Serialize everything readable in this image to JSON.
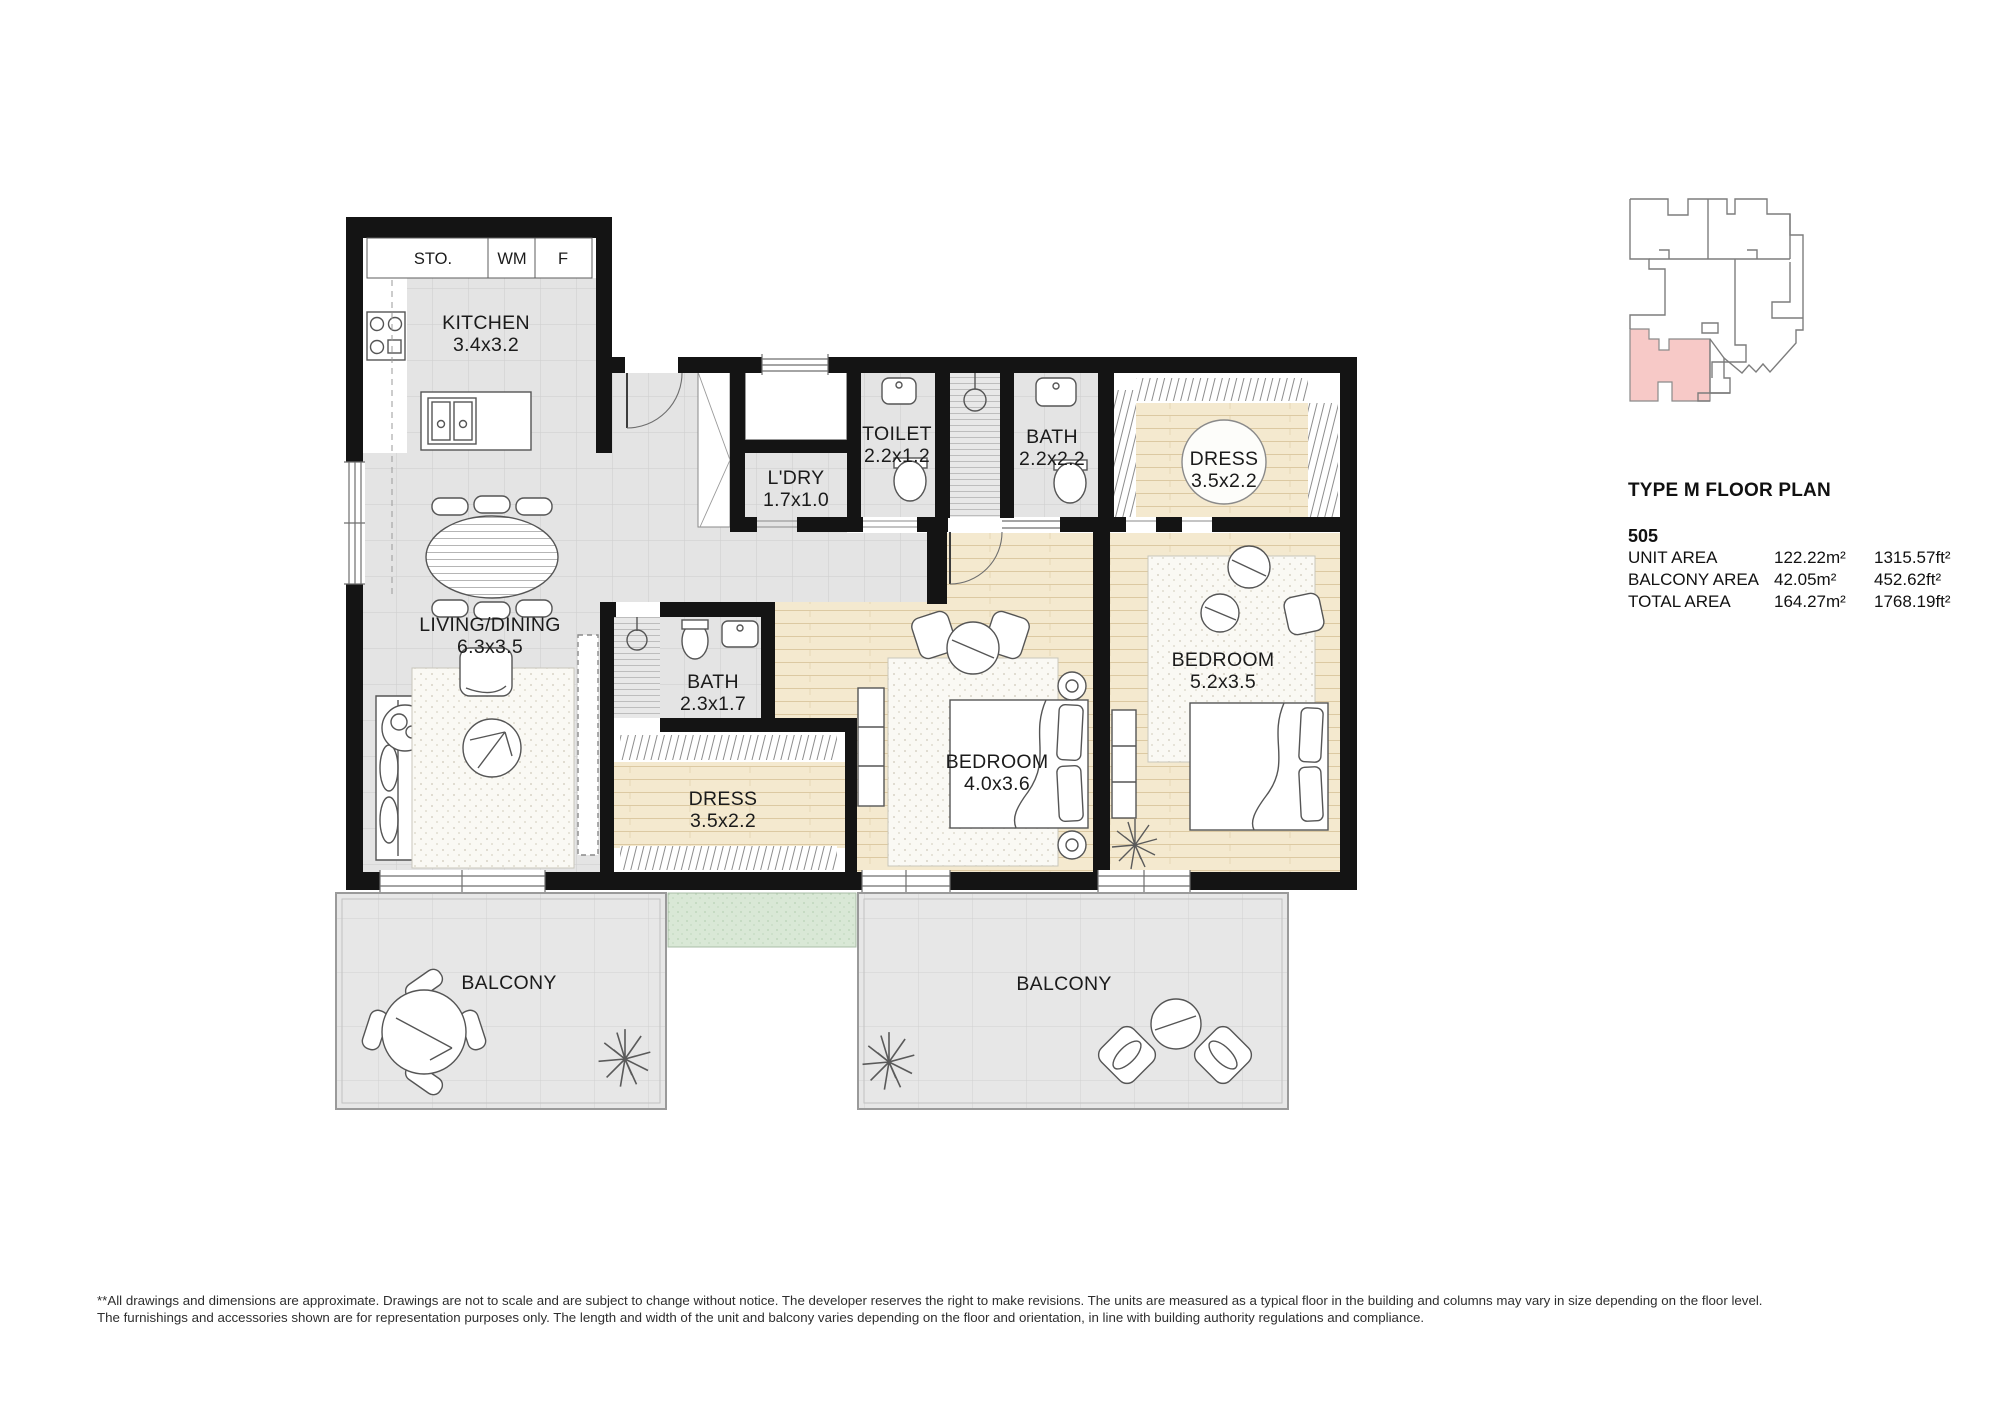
{
  "floorplan": {
    "closets": {
      "sto": "STO.",
      "wm": "WM",
      "f": "F"
    },
    "rooms": {
      "kitchen": {
        "name": "KITCHEN",
        "dims": "3.4x3.2"
      },
      "ldry": {
        "name": "L'DRY",
        "dims": "1.7x1.0"
      },
      "toilet": {
        "name": "TOILET",
        "dims": "2.2x1.2"
      },
      "bath_top": {
        "name": "BATH",
        "dims": "2.2x2.2"
      },
      "dress_top": {
        "name": "DRESS",
        "dims": "3.5x2.2"
      },
      "living": {
        "name": "LIVING/DINING",
        "dims": "6.3x3.5"
      },
      "bath_mid": {
        "name": "BATH",
        "dims": "2.3x1.7"
      },
      "dress_mid": {
        "name": "DRESS",
        "dims": "3.5x2.2"
      },
      "bedroom_1": {
        "name": "BEDROOM",
        "dims": "4.0x3.6"
      },
      "bedroom_2": {
        "name": "BEDROOM",
        "dims": "5.2x3.5"
      },
      "balcony_left": {
        "name": "BALCONY"
      },
      "balcony_right": {
        "name": "BALCONY"
      }
    },
    "colors": {
      "wall": "#141414",
      "tile": "#e4e4e4",
      "wood": "#f4e9cf",
      "planter": "#d9e8d6",
      "keyplan_highlight": "#f7c9c7"
    }
  },
  "info_panel": {
    "title": "TYPE M FLOOR PLAN",
    "unit_number": "505",
    "areas": [
      {
        "label": "UNIT AREA",
        "metric": "122.22m²",
        "imperial": "1315.57ft²"
      },
      {
        "label": "BALCONY AREA",
        "metric": "42.05m²",
        "imperial": "452.62ft²"
      },
      {
        "label": "TOTAL AREA",
        "metric": "164.27m²",
        "imperial": "1768.19ft²"
      }
    ]
  },
  "disclaimer": {
    "line1": "**All drawings and dimensions are approximate. Drawings are not to scale and are subject to change without notice. The developer reserves the right to make revisions. The units are measured as a typical floor in the building and columns may vary in size depending on the floor level.",
    "line2": "The furnishings and accessories shown are for representation purposes only. The length and width of the unit and balcony varies depending on the floor and orientation, in line with building authority regulations and compliance."
  }
}
